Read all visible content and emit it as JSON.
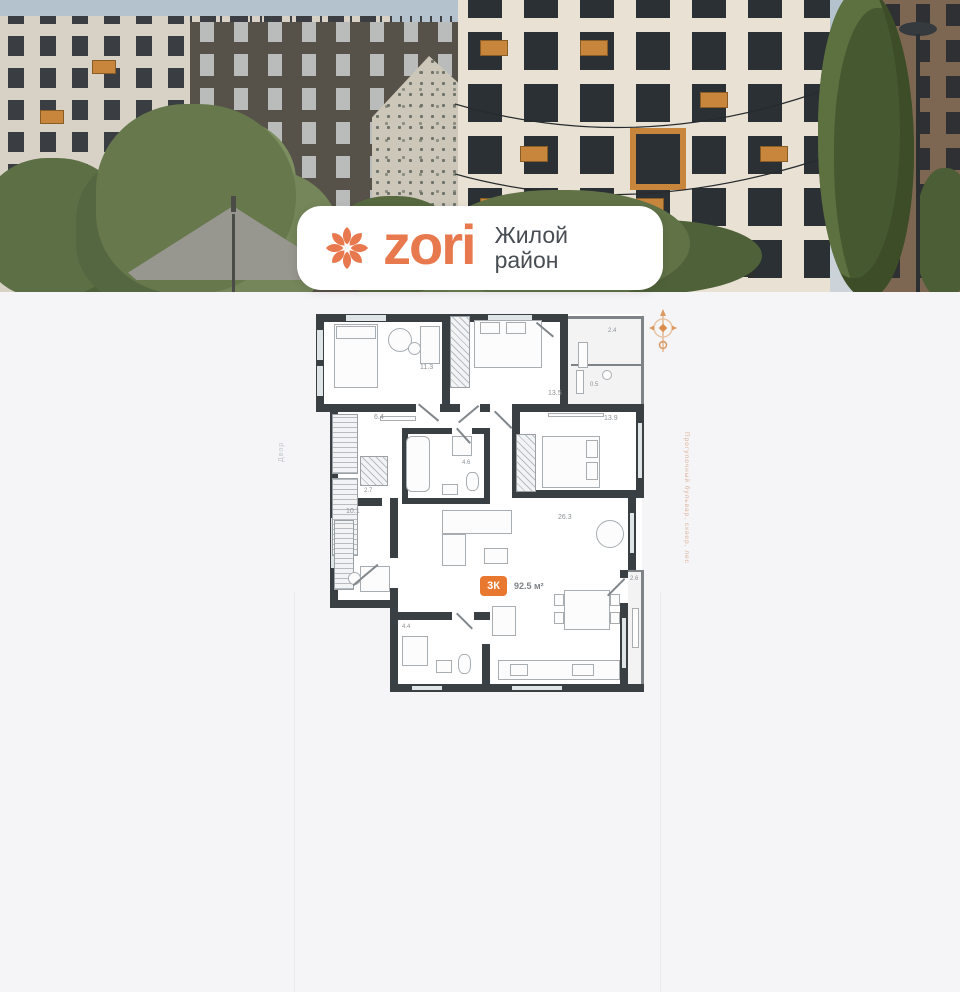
{
  "brand": {
    "logo_text": "zori",
    "tagline_line1": "Жилой",
    "tagline_line2": "район",
    "accent_color": "#e8794e"
  },
  "photo": {
    "building_number": "2"
  },
  "floor_plan": {
    "badge": {
      "rooms_label": "3К",
      "area_label": "92.5 м²"
    },
    "rooms": [
      {
        "id": "bedroom-1",
        "area": "11.3"
      },
      {
        "id": "bedroom-2",
        "area": "13.5"
      },
      {
        "id": "loggia-top",
        "area": "2.4"
      },
      {
        "id": "storage",
        "area": "0.5"
      },
      {
        "id": "hallway",
        "area": "6.4"
      },
      {
        "id": "bedroom-3",
        "area": "13.9"
      },
      {
        "id": "bathroom",
        "area": "4.6"
      },
      {
        "id": "wardrobe",
        "area": "2.7"
      },
      {
        "id": "cabinet",
        "area": "10.1"
      },
      {
        "id": "kitchen-living",
        "area": "26.3"
      },
      {
        "id": "shower-room",
        "area": "4.4"
      },
      {
        "id": "loggia-right",
        "area": "2.6"
      }
    ],
    "side_label_left": "Двор",
    "side_label_right": "Прогулочный бульвар, сквер, лес",
    "wall_color": "#3a3f43",
    "badge_color": "#e8772f"
  }
}
